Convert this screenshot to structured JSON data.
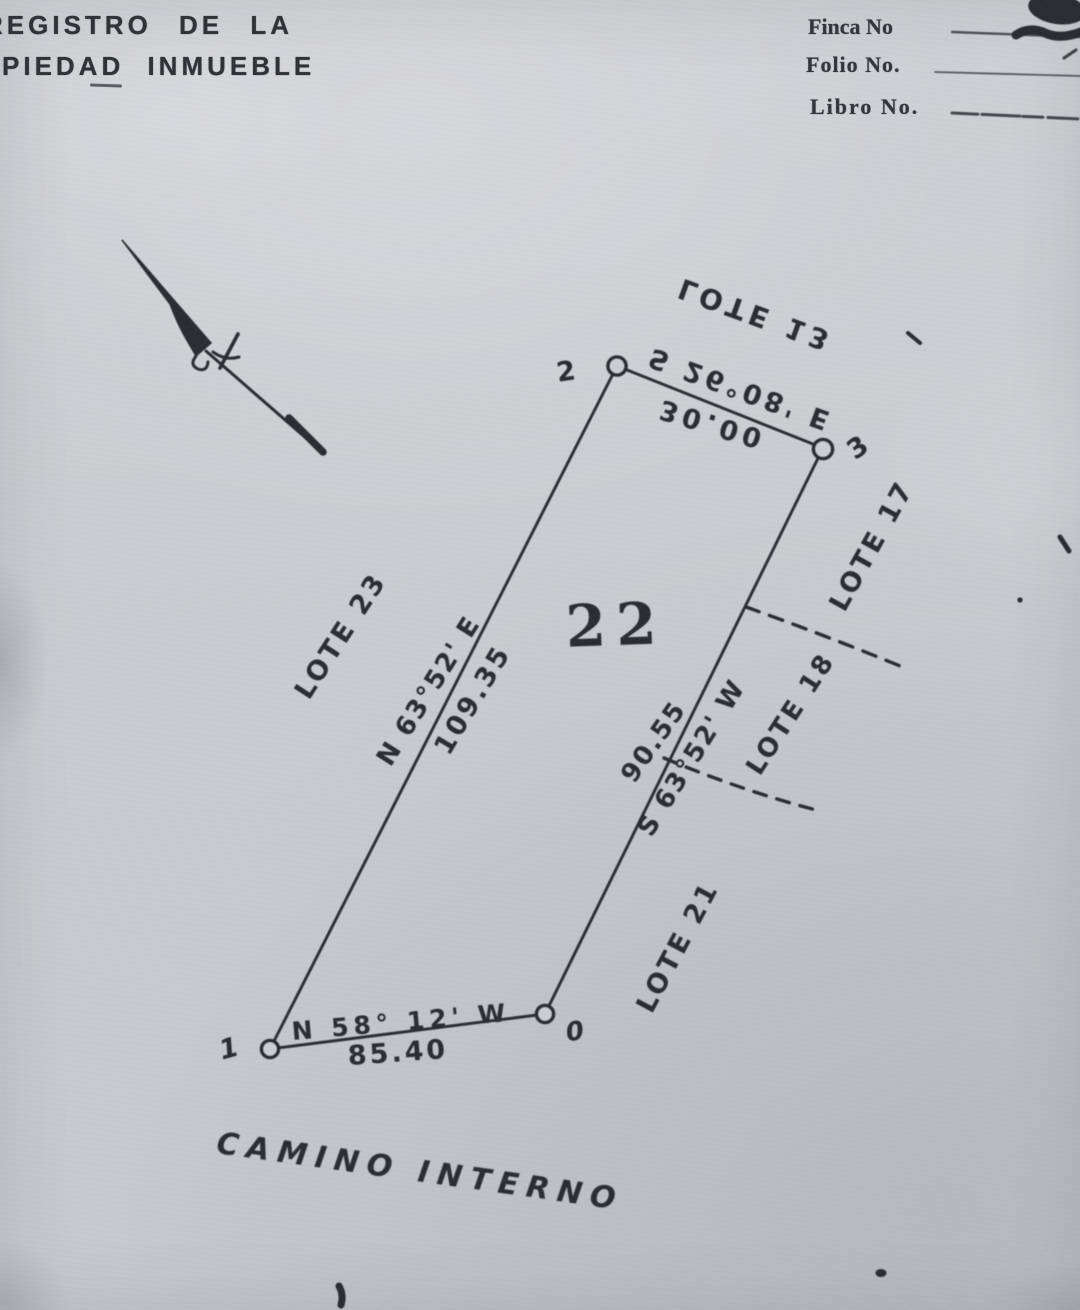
{
  "colors": {
    "paper": "#cbcdd0",
    "ink": "#2c2d31",
    "print": "#34363b"
  },
  "header": {
    "registry_line1": "REGISTRO DE LA",
    "registry_line2": "PIEDAD INMUEBLE",
    "fields": [
      {
        "label": "Finca No"
      },
      {
        "label": "Folio No."
      },
      {
        "label": "Libro No."
      }
    ]
  },
  "icons": {
    "north_arrow": "north-arrow-icon"
  },
  "parcel": {
    "number": "22",
    "corners": {
      "c1": "1",
      "c2": "2",
      "c3": "3",
      "c0": "0"
    },
    "sides": {
      "north": {
        "bearing": "S 26°08' E",
        "distance": "30.00"
      },
      "west": {
        "bearing": "N 63°52' E",
        "distance": "109.35"
      },
      "east": {
        "bearing": "S 63°52' W",
        "distance": "90.55"
      },
      "south": {
        "bearing": "N 58° 12' W",
        "distance": "85.40"
      }
    }
  },
  "neighbors": {
    "north": "LOTE 13",
    "east_upper": "LOTE 17",
    "east_middle": "LOTE 18",
    "east_lower": "LOTE 21",
    "west": "LOTE 23"
  },
  "road_label": "CAMINO INTERNO"
}
